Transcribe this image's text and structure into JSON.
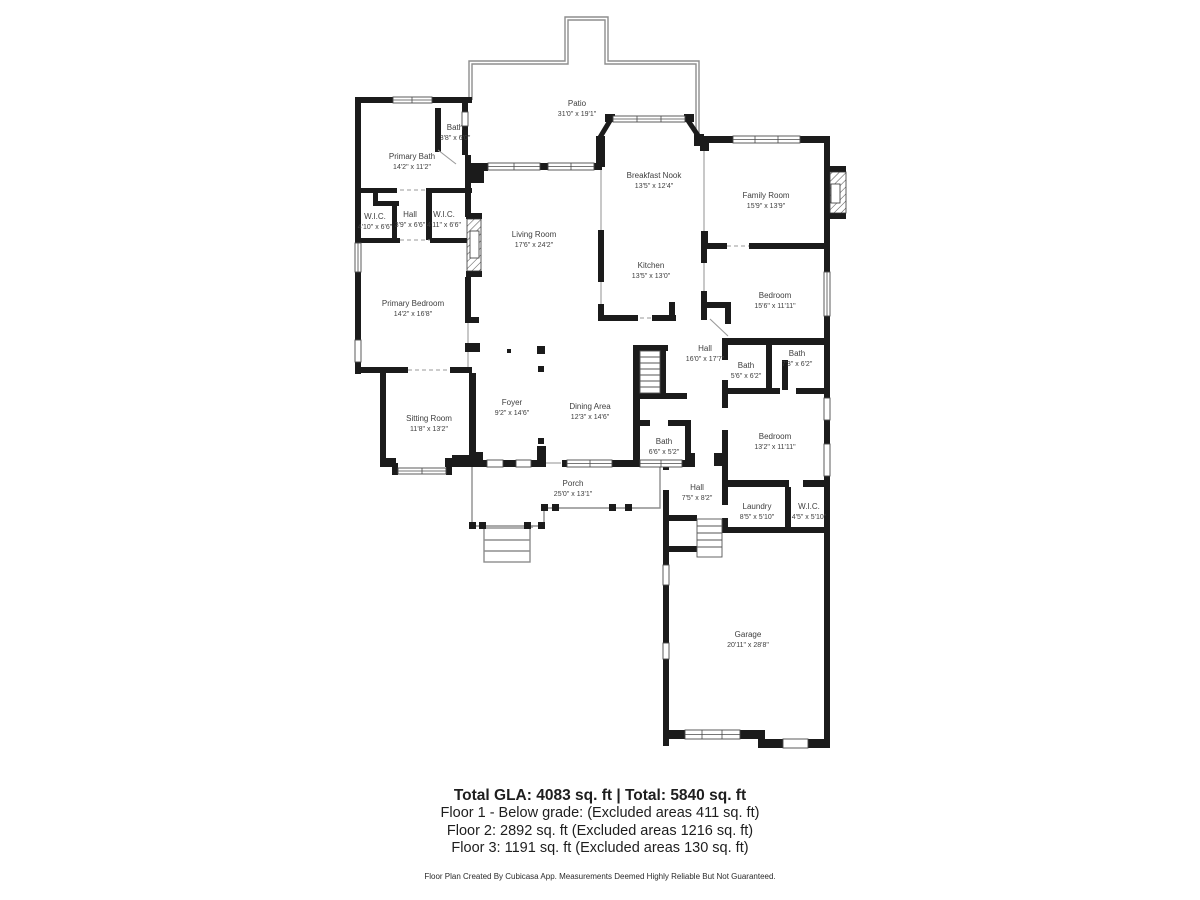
{
  "rooms": [
    {
      "id": "bath-upper",
      "name": "Bath",
      "dims": "3'8\" x 6'0\""
    },
    {
      "id": "primary-bath",
      "name": "Primary Bath",
      "dims": "14'2\" x 11'2\""
    },
    {
      "id": "wic-left",
      "name": "W.I.C.",
      "dims": "4'10\" x 6'6\""
    },
    {
      "id": "hall-small",
      "name": "Hall",
      "dims": "3'9\" x 6'6\""
    },
    {
      "id": "wic-right",
      "name": "W.I.C.",
      "dims": "4'11\" x 6'6\""
    },
    {
      "id": "primary-bedroom",
      "name": "Primary Bedroom",
      "dims": "14'2\" x 16'8\""
    },
    {
      "id": "sitting-room",
      "name": "Sitting Room",
      "dims": "11'8\" x 13'2\""
    },
    {
      "id": "living-room",
      "name": "Living Room",
      "dims": "17'6\" x 24'2\""
    },
    {
      "id": "patio",
      "name": "Patio",
      "dims": "31'0\" x 19'1\""
    },
    {
      "id": "breakfast-nook",
      "name": "Breakfast Nook",
      "dims": "13'5\" x 12'4\""
    },
    {
      "id": "kitchen",
      "name": "Kitchen",
      "dims": "13'5\" x 13'0\""
    },
    {
      "id": "family-room",
      "name": "Family Room",
      "dims": "15'9\" x 13'9\""
    },
    {
      "id": "bedroom-2",
      "name": "Bedroom",
      "dims": "15'6\" x 11'11\""
    },
    {
      "id": "hall-center",
      "name": "Hall",
      "dims": "16'0\" x 17'7\""
    },
    {
      "id": "bath-56",
      "name": "Bath",
      "dims": "5'6\" x 6'2\""
    },
    {
      "id": "bath-73",
      "name": "Bath",
      "dims": "7'3\" x 6'2\""
    },
    {
      "id": "bedroom-3",
      "name": "Bedroom",
      "dims": "13'2\" x 11'11\""
    },
    {
      "id": "bath-66",
      "name": "Bath",
      "dims": "6'6\" x 5'2\""
    },
    {
      "id": "foyer",
      "name": "Foyer",
      "dims": "9'2\" x 14'6\""
    },
    {
      "id": "dining-area",
      "name": "Dining Area",
      "dims": "12'3\" x 14'6\""
    },
    {
      "id": "porch",
      "name": "Porch",
      "dims": "25'0\" x 13'1\""
    },
    {
      "id": "hall-lower",
      "name": "Hall",
      "dims": "7'5\" x 8'2\""
    },
    {
      "id": "laundry",
      "name": "Laundry",
      "dims": "8'5\" x 5'10\""
    },
    {
      "id": "wic-2",
      "name": "W.I.C.",
      "dims": "4'5\" x 5'10\""
    },
    {
      "id": "garage",
      "name": "Garage",
      "dims": "20'11\" x 28'8\""
    }
  ],
  "footer": {
    "line1": "Total GLA: 4083 sq. ft | Total: 5840 sq. ft",
    "line2": "Floor 1 - Below grade: (Excluded areas 411 sq. ft)",
    "line3": "Floor 2: 2892 sq. ft (Excluded areas 1216 sq. ft)",
    "line4": "Floor 3: 1191 sq. ft (Excluded areas 130 sq. ft)",
    "disclaimer": "Floor Plan Created By Cubicasa App. Measurements Deemed Highly Reliable But Not Guaranteed."
  },
  "colors": {
    "wall": "#1b1b1b",
    "thin_line": "#8d8d8d",
    "label_text": "#3e3e3e",
    "background": "#ffffff"
  }
}
